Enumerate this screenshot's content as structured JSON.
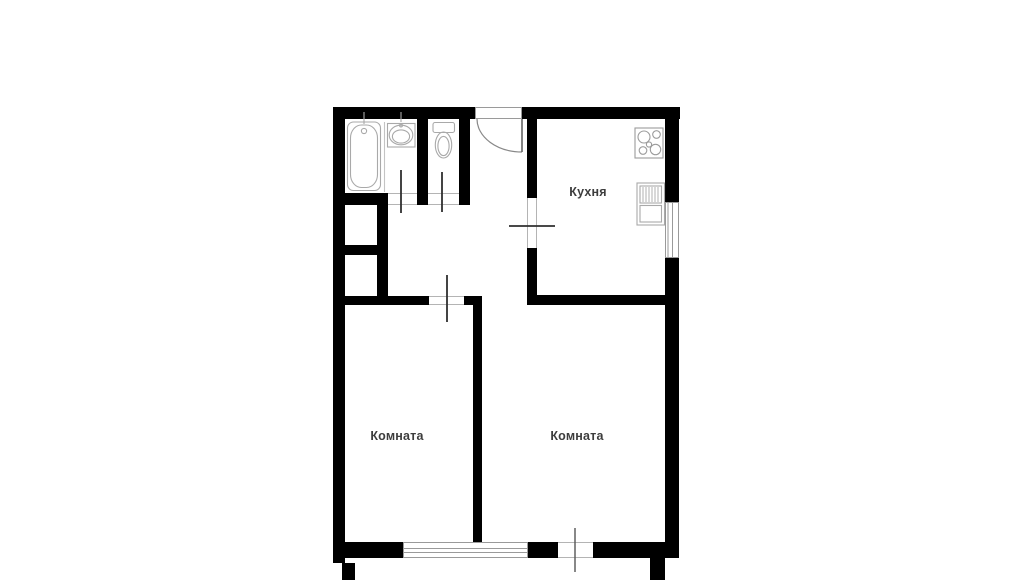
{
  "plan": {
    "type": "apartment-floor-plan",
    "colors": {
      "background": "#ffffff",
      "walls": "#000000",
      "labels": "#3d3d3d",
      "fixtures": "#a9a9a9",
      "door_leaf": "#2f2f2f"
    },
    "rooms": {
      "kitchen": {
        "label": "Кухня"
      },
      "room_left": {
        "label": "Комната"
      },
      "room_right": {
        "label": "Комната"
      }
    },
    "fixtures": [
      "bathtub-icon",
      "bath-sink-icon",
      "toilet-icon",
      "stove-icon",
      "kitchen-sink-icon"
    ],
    "doors": [
      "entry-door",
      "bathroom-door",
      "toilet-door",
      "kitchen-door",
      "left-room-door",
      "balcony-door"
    ],
    "windows": [
      "left-room-window",
      "kitchen-window"
    ]
  }
}
